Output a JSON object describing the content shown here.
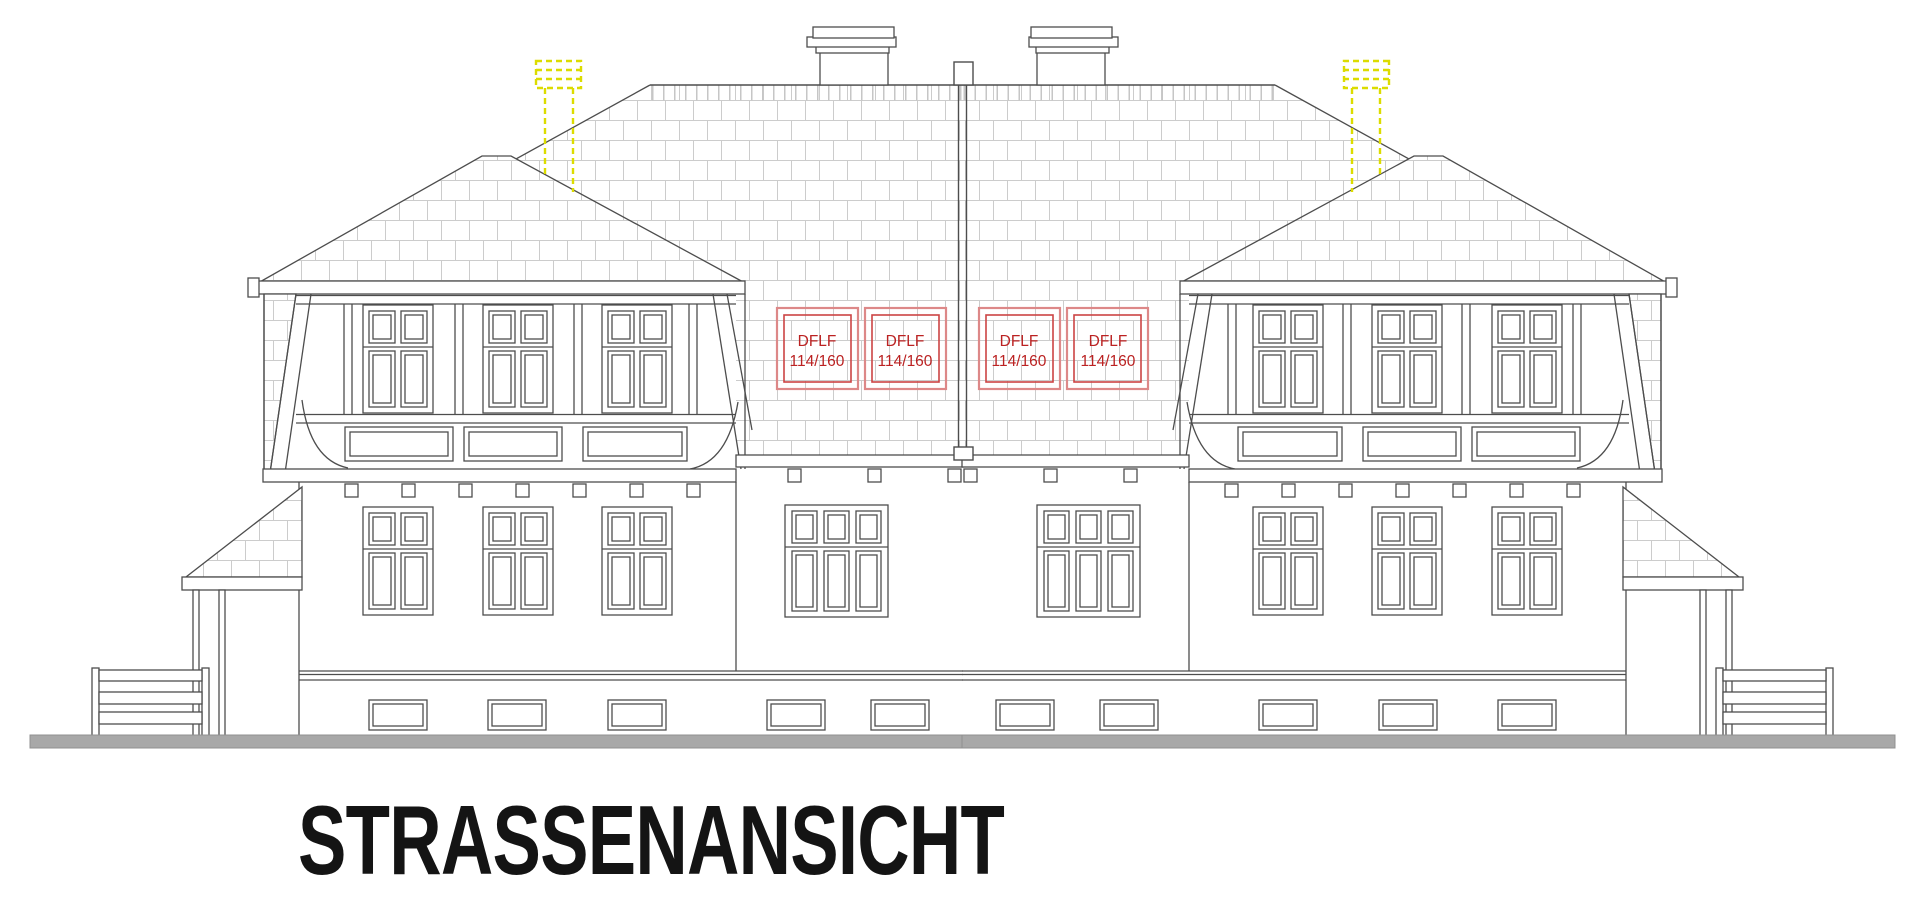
{
  "title": {
    "text": "STRASSENANSICHT"
  },
  "drawing": {
    "roof_window_labels": [
      {
        "line1": "DFLF",
        "line2": "114/160"
      },
      {
        "line1": "DFLF",
        "line2": "114/160"
      },
      {
        "line1": "DFLF",
        "line2": "114/160"
      },
      {
        "line1": "DFLF",
        "line2": "114/160"
      }
    ],
    "colors": {
      "linework": "#4d4d4d",
      "roof_hatch": "#cccccc",
      "roof_window_box_outer": "#dd8888",
      "roof_window_box_inner": "#cc4444",
      "roof_window_text": "#bb2222",
      "vent_yellow": "#dcdc00",
      "ground_gray": "#a8a8a8"
    }
  }
}
